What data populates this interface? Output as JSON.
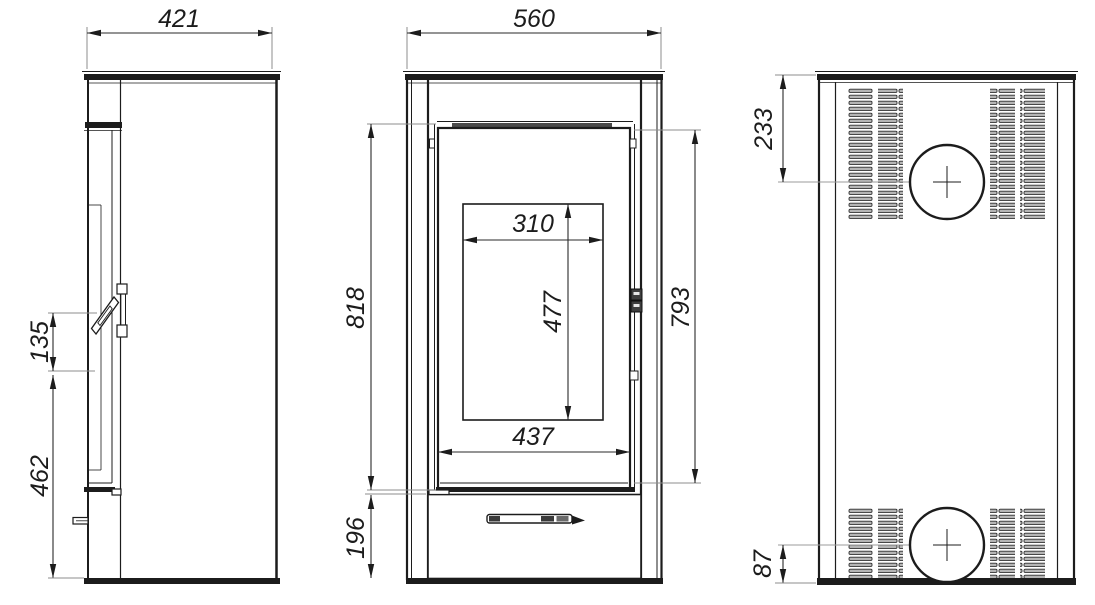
{
  "drawing": {
    "title": "Wood stove dimensioned technical drawing",
    "background": "#ffffff",
    "line_color": "#1c1c1c",
    "dimension_color": "#2a2a2a",
    "views": {
      "side_view": {
        "label": "side-view",
        "dimensions": {
          "depth": "421",
          "handle_length": "135",
          "handle_bottom_to_floor": "462"
        }
      },
      "front_view": {
        "label": "front-view",
        "dimensions": {
          "width": "560",
          "door_frame_height": "818",
          "glass_width": "310",
          "glass_height": "477",
          "door_leaf_height": "793",
          "door_width": "437",
          "pedestal_height": "196"
        }
      },
      "back_view": {
        "label": "back-view",
        "dimensions": {
          "flue_center_from_top": "233",
          "flue_center_from_bottom": "87"
        }
      }
    }
  }
}
